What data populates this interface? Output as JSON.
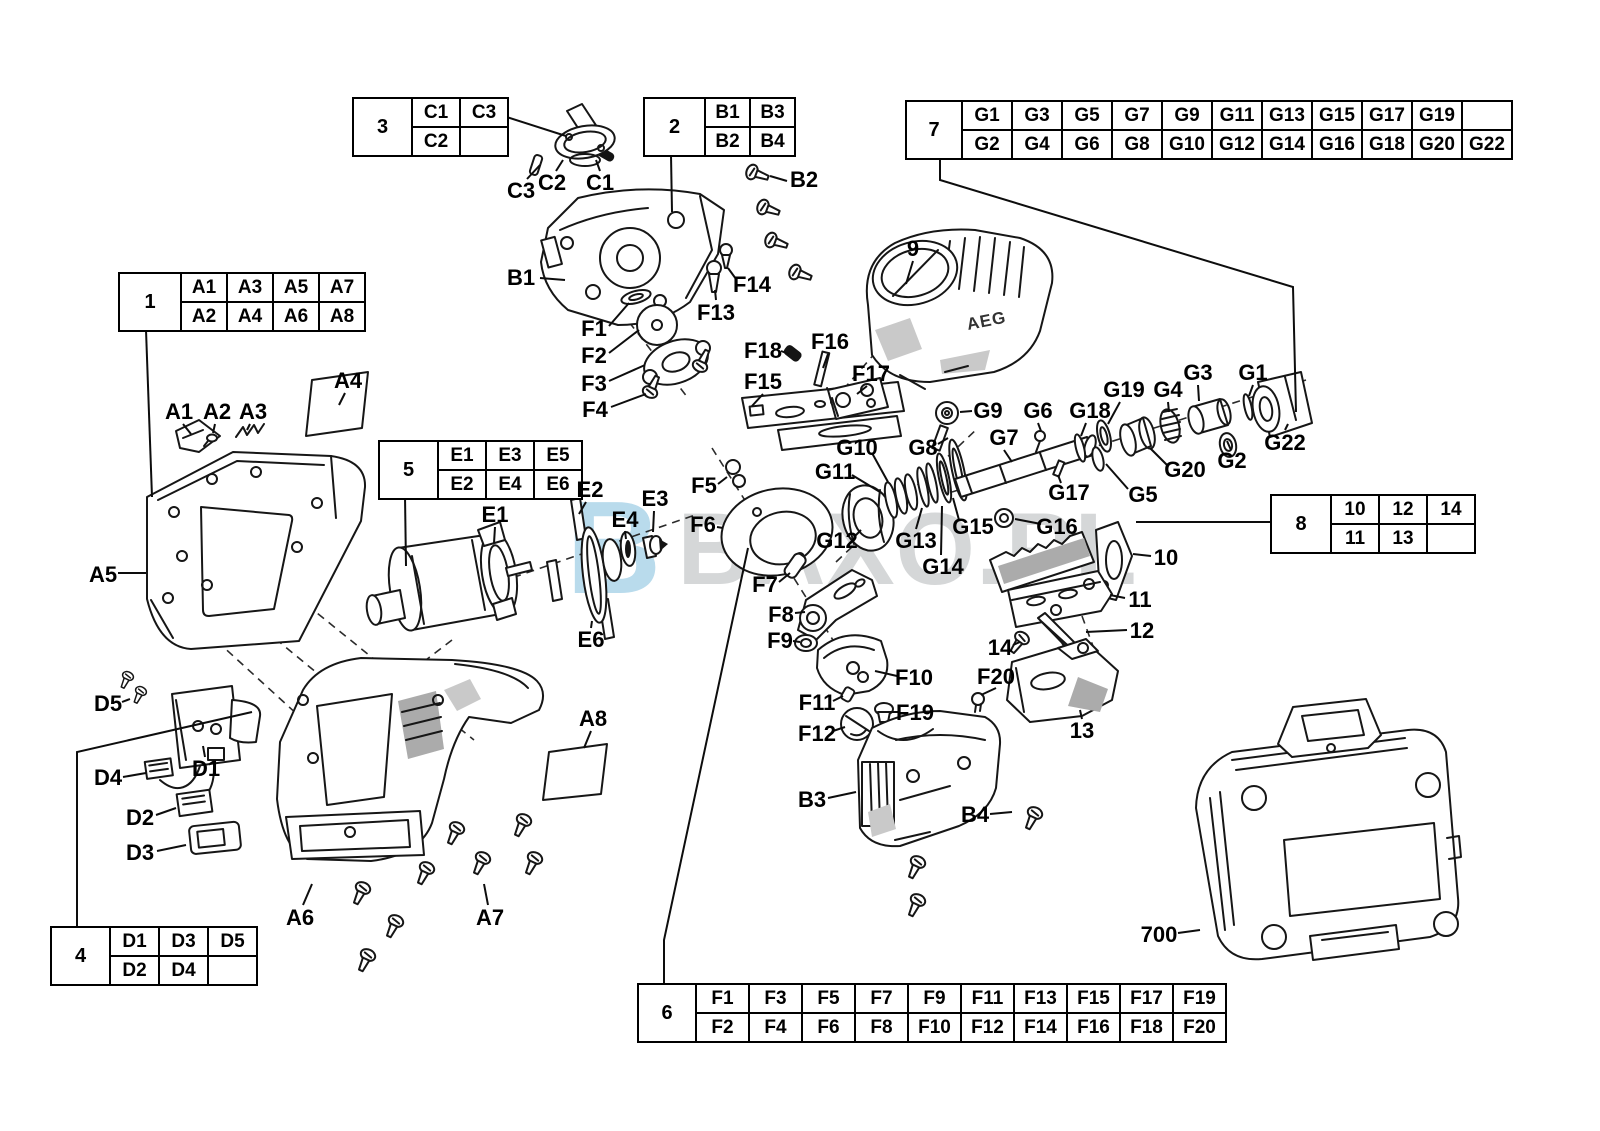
{
  "watermark": {
    "logo": "B",
    "text": "BAXO.PL",
    "logo_color": "#b9dbec",
    "text_color": "#d5d7d8"
  },
  "drawing": {
    "motor_brand": "AEG"
  },
  "tables": [
    {
      "header": "1",
      "x": 118,
      "y": 272,
      "header_w": 56,
      "col_w": 40,
      "rows": [
        [
          "A1",
          "A3",
          "A5",
          "A7"
        ],
        [
          "A2",
          "A4",
          "A6",
          "A8"
        ]
      ]
    },
    {
      "header": "3",
      "x": 352,
      "y": 97,
      "header_w": 53,
      "col_w": 42,
      "rows": [
        [
          "C1",
          "C3"
        ],
        [
          "C2",
          ""
        ]
      ]
    },
    {
      "header": "2",
      "x": 643,
      "y": 97,
      "header_w": 55,
      "col_w": 39,
      "rows": [
        [
          "B1",
          "B3"
        ],
        [
          "B2",
          "B4"
        ]
      ]
    },
    {
      "header": "7",
      "x": 905,
      "y": 100,
      "header_w": 50,
      "col_w": 44,
      "rows": [
        [
          "G1",
          "G3",
          "G5",
          "G7",
          "G9",
          "G11",
          "G13",
          "G15",
          "G17",
          "G19",
          ""
        ],
        [
          "G2",
          "G4",
          "G6",
          "G8",
          "G10",
          "G12",
          "G14",
          "G16",
          "G18",
          "G20",
          "G22"
        ]
      ]
    },
    {
      "header": "5",
      "x": 378,
      "y": 440,
      "header_w": 53,
      "col_w": 42,
      "rows": [
        [
          "E1",
          "E3",
          "E5"
        ],
        [
          "E2",
          "E4",
          "E6"
        ]
      ]
    },
    {
      "header": "8",
      "x": 1270,
      "y": 494,
      "header_w": 54,
      "col_w": 42,
      "rows": [
        [
          "10",
          "12",
          "14"
        ],
        [
          "11",
          "13",
          ""
        ]
      ]
    },
    {
      "header": "4",
      "x": 50,
      "y": 926,
      "header_w": 53,
      "col_w": 43,
      "rows": [
        [
          "D1",
          "D3",
          "D5"
        ],
        [
          "D2",
          "D4",
          ""
        ]
      ]
    },
    {
      "header": "6",
      "x": 637,
      "y": 983,
      "header_w": 52,
      "col_w": 47,
      "rows": [
        [
          "F1",
          "F3",
          "F5",
          "F7",
          "F9",
          "F11",
          "F13",
          "F15",
          "F17",
          "F19"
        ],
        [
          "F2",
          "F4",
          "F6",
          "F8",
          "F10",
          "F12",
          "F14",
          "F16",
          "F18",
          "F20"
        ]
      ]
    }
  ],
  "connectors": [
    [
      [
        491,
        112
      ],
      [
        566,
        136
      ]
    ],
    [
      [
        671,
        155
      ],
      [
        672,
        212
      ]
    ],
    [
      [
        940,
        158
      ],
      [
        940,
        180
      ],
      [
        1293,
        287
      ],
      [
        1296,
        412
      ]
    ],
    [
      [
        146,
        330
      ],
      [
        152,
        497
      ]
    ],
    [
      [
        405,
        496
      ],
      [
        406,
        566
      ]
    ],
    [
      [
        1270,
        522
      ],
      [
        1136,
        522
      ]
    ],
    [
      [
        77,
        926
      ],
      [
        77,
        752
      ],
      [
        252,
        712
      ]
    ],
    [
      [
        664,
        983
      ],
      [
        664,
        940
      ],
      [
        748,
        548
      ]
    ]
  ],
  "labels": [
    {
      "text": "C3",
      "x": 521,
      "y": 191,
      "line": [
        527,
        179,
        540,
        165
      ]
    },
    {
      "text": "C2",
      "x": 552,
      "y": 183,
      "line": [
        556,
        171,
        563,
        160
      ]
    },
    {
      "text": "C1",
      "x": 600,
      "y": 183,
      "line": [
        600,
        171,
        596,
        160
      ]
    },
    {
      "text": "B2",
      "x": 804,
      "y": 180,
      "line": [
        787,
        181,
        770,
        176
      ]
    },
    {
      "text": "B1",
      "x": 521,
      "y": 278,
      "line": [
        540,
        278,
        565,
        280
      ]
    },
    {
      "text": "F14",
      "x": 752,
      "y": 285,
      "line": [
        736,
        279,
        728,
        268
      ]
    },
    {
      "text": "F13",
      "x": 716,
      "y": 313,
      "line": [
        716,
        300,
        715,
        290
      ]
    },
    {
      "text": "F1",
      "x": 594,
      "y": 329,
      "line": [
        609,
        326,
        629,
        303
      ]
    },
    {
      "text": "F2",
      "x": 594,
      "y": 356,
      "line": [
        609,
        353,
        639,
        330
      ]
    },
    {
      "text": "F3",
      "x": 594,
      "y": 384,
      "line": [
        609,
        381,
        645,
        365
      ]
    },
    {
      "text": "F4",
      "x": 595,
      "y": 410,
      "line": [
        611,
        407,
        646,
        394
      ]
    },
    {
      "text": "F18",
      "x": 763,
      "y": 351,
      "line": [
        781,
        351,
        789,
        354
      ]
    },
    {
      "text": "F16",
      "x": 830,
      "y": 342,
      "line": [
        828,
        354,
        823,
        368
      ]
    },
    {
      "text": "F15",
      "x": 763,
      "y": 382,
      "line": [
        763,
        394,
        752,
        406
      ]
    },
    {
      "text": "F17",
      "x": 871,
      "y": 374,
      "line": [
        867,
        386,
        857,
        394
      ]
    },
    {
      "text": "9",
      "x": 913,
      "y": 249,
      "line": [
        913,
        261,
        906,
        284
      ]
    },
    {
      "text": "G9",
      "x": 988,
      "y": 411,
      "line": [
        972,
        411,
        960,
        412
      ]
    },
    {
      "text": "G8",
      "x": 923,
      "y": 448,
      "line": [
        938,
        444,
        948,
        438
      ]
    },
    {
      "text": "G6",
      "x": 1038,
      "y": 411,
      "line": [
        1038,
        423,
        1041,
        431
      ]
    },
    {
      "text": "G7",
      "x": 1004,
      "y": 438,
      "line": [
        1004,
        450,
        1012,
        462
      ]
    },
    {
      "text": "G18",
      "x": 1090,
      "y": 411,
      "line": [
        1086,
        423,
        1081,
        436
      ]
    },
    {
      "text": "G19",
      "x": 1124,
      "y": 390,
      "line": [
        1120,
        402,
        1108,
        424
      ]
    },
    {
      "text": "G4",
      "x": 1168,
      "y": 390,
      "line": [
        1168,
        402,
        1169,
        412
      ]
    },
    {
      "text": "G3",
      "x": 1198,
      "y": 373,
      "line": [
        1198,
        385,
        1199,
        401
      ]
    },
    {
      "text": "G1",
      "x": 1253,
      "y": 373,
      "line": [
        1253,
        385,
        1249,
        396
      ]
    },
    {
      "text": "G2",
      "x": 1232,
      "y": 461,
      "line": [
        1231,
        450,
        1227,
        441
      ]
    },
    {
      "text": "G20",
      "x": 1185,
      "y": 470,
      "line": [
        1168,
        466,
        1150,
        448
      ]
    },
    {
      "text": "G22",
      "x": 1285,
      "y": 443,
      "line": [
        1285,
        430,
        1288,
        424
      ]
    },
    {
      "text": "G17",
      "x": 1069,
      "y": 493,
      "line": [
        1061,
        483,
        1058,
        475
      ]
    },
    {
      "text": "G5",
      "x": 1143,
      "y": 495,
      "line": [
        1128,
        489,
        1106,
        464
      ]
    },
    {
      "text": "G10",
      "x": 857,
      "y": 448,
      "line": [
        872,
        453,
        888,
        482
      ]
    },
    {
      "text": "G11",
      "x": 835,
      "y": 472,
      "line": [
        852,
        475,
        880,
        492
      ]
    },
    {
      "text": "G12",
      "x": 837,
      "y": 541,
      "line": [
        854,
        537,
        861,
        530
      ]
    },
    {
      "text": "G13",
      "x": 916,
      "y": 541,
      "line": [
        916,
        529,
        922,
        508
      ]
    },
    {
      "text": "G15",
      "x": 973,
      "y": 527,
      "line": [
        959,
        520,
        953,
        498
      ]
    },
    {
      "text": "G14",
      "x": 943,
      "y": 567,
      "line": [
        941,
        555,
        942,
        506
      ]
    },
    {
      "text": "G16",
      "x": 1057,
      "y": 527,
      "line": [
        1041,
        524,
        1015,
        519
      ]
    },
    {
      "text": "A4",
      "x": 348,
      "y": 381,
      "line": [
        345,
        393,
        339,
        405
      ]
    },
    {
      "text": "A1",
      "x": 179,
      "y": 412,
      "line": [
        183,
        424,
        191,
        434
      ]
    },
    {
      "text": "A2",
      "x": 217,
      "y": 412,
      "line": [
        215,
        424,
        213,
        433
      ]
    },
    {
      "text": "A3",
      "x": 253,
      "y": 412,
      "line": [
        250,
        424,
        247,
        430
      ]
    },
    {
      "text": "A5",
      "x": 103,
      "y": 575,
      "line": [
        118,
        573,
        146,
        573
      ]
    },
    {
      "text": "E1",
      "x": 495,
      "y": 515,
      "line": [
        495,
        527,
        494,
        543
      ]
    },
    {
      "text": "E2",
      "x": 590,
      "y": 490,
      "line": [
        586,
        502,
        579,
        514
      ]
    },
    {
      "text": "E3",
      "x": 655,
      "y": 499,
      "line": [
        654,
        511,
        653,
        532
      ]
    },
    {
      "text": "E4",
      "x": 625,
      "y": 520,
      "line": [
        625,
        531,
        626,
        539
      ]
    },
    {
      "text": "E6",
      "x": 591,
      "y": 640,
      "line": [
        591,
        628,
        592,
        621
      ]
    },
    {
      "text": "F5",
      "x": 704,
      "y": 486,
      "line": [
        718,
        484,
        727,
        477
      ]
    },
    {
      "text": "F6",
      "x": 703,
      "y": 525,
      "line": [
        717,
        527,
        723,
        528
      ]
    },
    {
      "text": "F7",
      "x": 765,
      "y": 585,
      "line": [
        779,
        582,
        790,
        573
      ]
    },
    {
      "text": "F8",
      "x": 781,
      "y": 615,
      "line": [
        795,
        613,
        805,
        612
      ]
    },
    {
      "text": "F9",
      "x": 780,
      "y": 641,
      "line": [
        793,
        641,
        800,
        642
      ]
    },
    {
      "text": "F10",
      "x": 914,
      "y": 678,
      "line": [
        897,
        676,
        875,
        671
      ]
    },
    {
      "text": "F11",
      "x": 817,
      "y": 703,
      "line": [
        833,
        701,
        843,
        696
      ]
    },
    {
      "text": "F12",
      "x": 817,
      "y": 734,
      "line": [
        833,
        731,
        845,
        727
      ]
    },
    {
      "text": "F19",
      "x": 915,
      "y": 713,
      "line": [
        898,
        712,
        890,
        712
      ]
    },
    {
      "text": "F20",
      "x": 996,
      "y": 677,
      "line": [
        996,
        688,
        981,
        695
      ]
    },
    {
      "text": "14",
      "x": 1000,
      "y": 648,
      "line": [
        1013,
        645,
        1020,
        642
      ]
    },
    {
      "text": "13",
      "x": 1082,
      "y": 731,
      "line": [
        1082,
        719,
        1080,
        710
      ]
    },
    {
      "text": "10",
      "x": 1166,
      "y": 558,
      "line": [
        1151,
        556,
        1133,
        554
      ]
    },
    {
      "text": "11",
      "x": 1140,
      "y": 600,
      "line": [
        1125,
        598,
        1110,
        595
      ]
    },
    {
      "text": "12",
      "x": 1142,
      "y": 631,
      "line": [
        1127,
        630,
        1086,
        632
      ]
    },
    {
      "text": "B3",
      "x": 812,
      "y": 800,
      "line": [
        828,
        798,
        856,
        792
      ]
    },
    {
      "text": "B4",
      "x": 975,
      "y": 815,
      "line": [
        990,
        814,
        1012,
        812
      ]
    },
    {
      "text": "A6",
      "x": 300,
      "y": 918,
      "line": [
        303,
        905,
        312,
        884
      ]
    },
    {
      "text": "A7",
      "x": 490,
      "y": 918,
      "line": [
        488,
        905,
        484,
        884
      ]
    },
    {
      "text": "A8",
      "x": 593,
      "y": 719,
      "line": [
        591,
        731,
        584,
        748
      ]
    },
    {
      "text": "D5",
      "x": 108,
      "y": 704,
      "line": [
        122,
        702,
        130,
        699
      ]
    },
    {
      "text": "D1",
      "x": 206,
      "y": 769,
      "line": [
        205,
        757,
        203,
        746
      ]
    },
    {
      "text": "D4",
      "x": 108,
      "y": 778,
      "line": [
        123,
        777,
        146,
        773
      ]
    },
    {
      "text": "D2",
      "x": 140,
      "y": 818,
      "line": [
        156,
        815,
        176,
        808
      ]
    },
    {
      "text": "D3",
      "x": 140,
      "y": 853,
      "line": [
        157,
        851,
        186,
        845
      ]
    },
    {
      "text": "700",
      "x": 1159,
      "y": 935,
      "line": [
        1178,
        933,
        1200,
        930
      ]
    }
  ]
}
